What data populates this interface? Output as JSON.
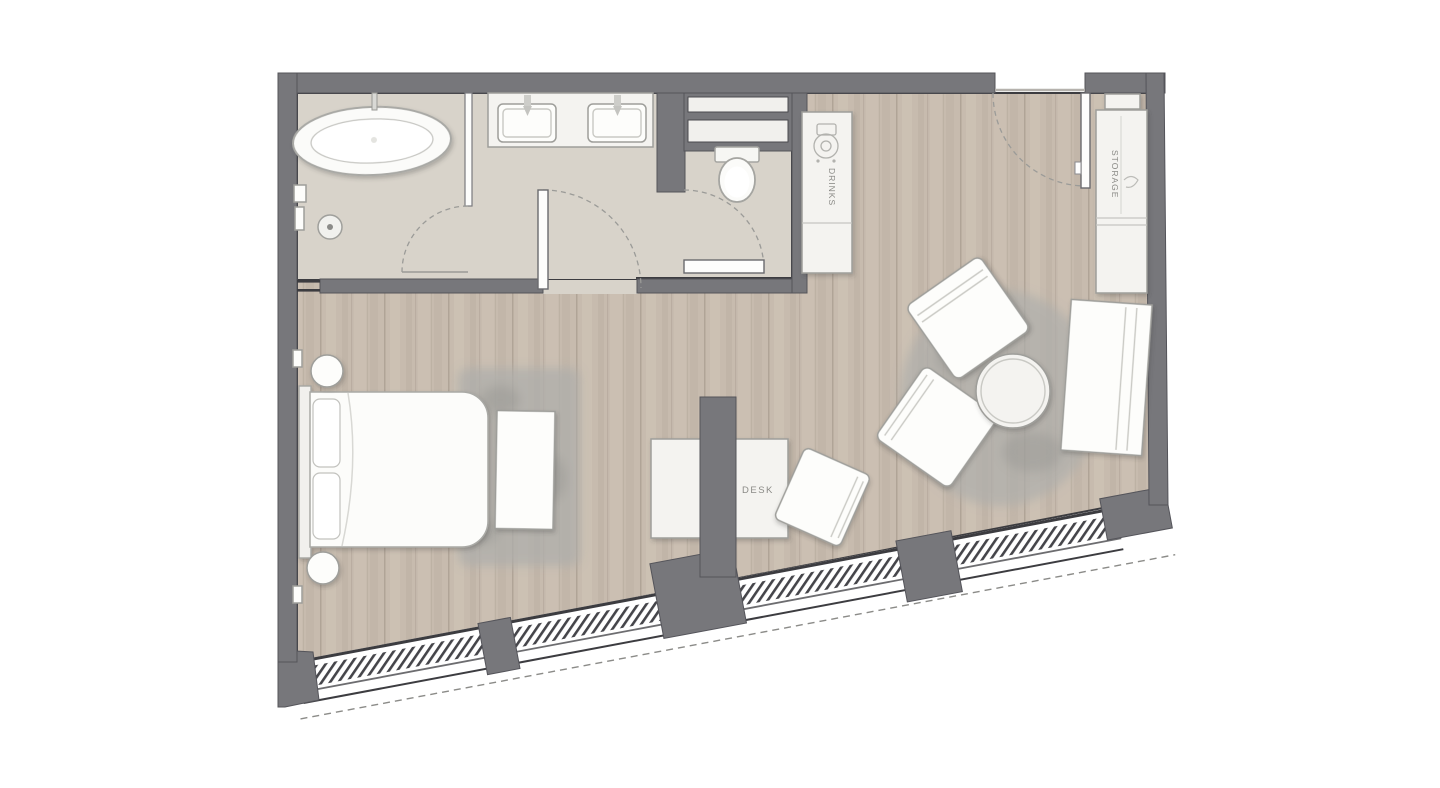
{
  "plan": {
    "type": "floor-plan",
    "labels": {
      "drinks": "DRINKS",
      "storage": "STORAGE",
      "desk": "DESK"
    },
    "fixtures": [
      "bathtub",
      "shower-head",
      "double-sink-vanity",
      "toilet",
      "wall-shelves",
      "drinks-cabinet",
      "entry-door",
      "storage-wardrobe",
      "bed",
      "nightstand",
      "wall-lamp",
      "bench",
      "area-rug",
      "desk",
      "desk-chair",
      "armchair",
      "round-table",
      "daybed-sofa",
      "structural-column",
      "window-wall"
    ]
  },
  "colors": {
    "bg": "#ffffff",
    "wall": "#77777b",
    "wall-dark": "#54545a",
    "line": "#3c3c40",
    "bath-floor": "#d8d3ca",
    "wood-1": "#c7bbae",
    "wood-2": "#cfc4b6",
    "wood-3": "#bdb1a4",
    "wood-line": "#b0a497",
    "furniture": "#f4f3f0",
    "furniture-line": "#9e9e9a",
    "rug": "#aeaeab",
    "label": "#8a8a86",
    "arc": "#9b9b98",
    "hatch": "#45454a",
    "shelf-slot": "#f1f0ed"
  }
}
